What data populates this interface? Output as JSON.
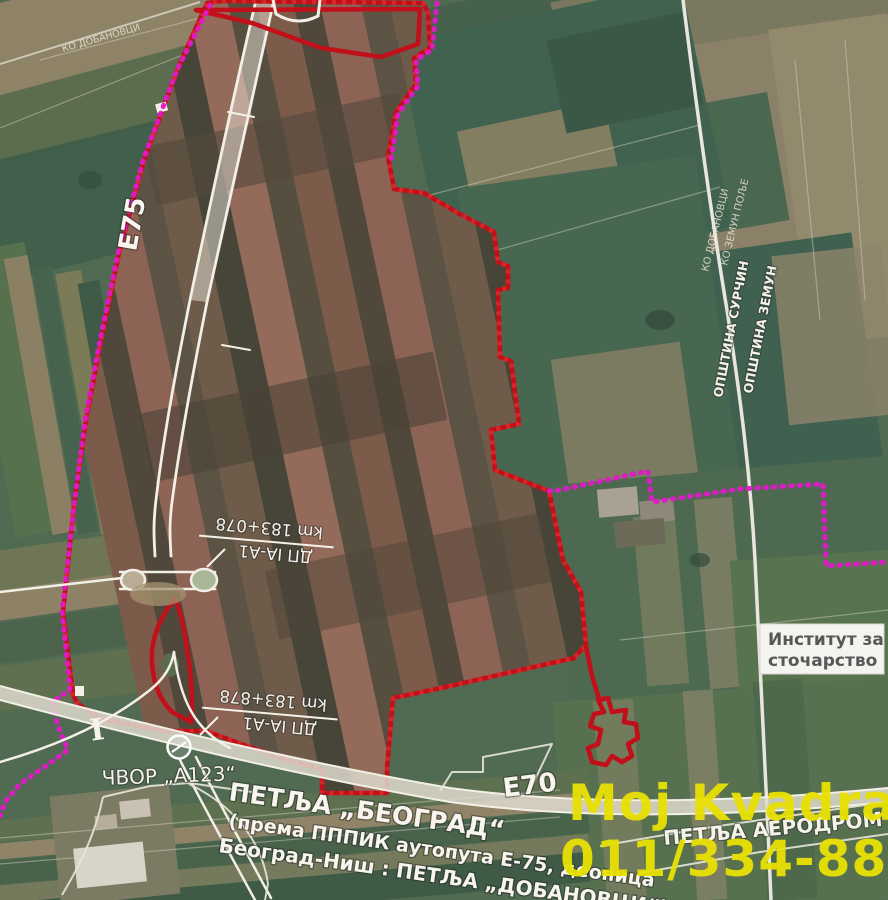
{
  "map": {
    "highway_labels": {
      "e75": "E75",
      "e70": "E70"
    },
    "junction": {
      "cvor": "ЧВОР „А123“",
      "petlja_title": "ПЕТЉА „БЕОГРАД“",
      "petlja_sub1": "(према ПППИК аутопута Е-75, деоница",
      "petlja_sub2": "Београд-Ниш : ПЕТЉА „ДОБАНОВЦИ“)",
      "petlja_aerodrom": "ПЕТЉА АЕРОДРОМ"
    },
    "road_markers": [
      {
        "road": "ДП IА-А1",
        "km": "km 183+078"
      },
      {
        "road": "ДП IА-А1",
        "km": "km 183+878"
      }
    ],
    "admin_labels": {
      "municipality_left": "ОПШТИНА СУРЧИН",
      "municipality_right": "ОПШТИНА ЗЕМУН",
      "cadastre_right_west": "КО ДОБАНОВЦИ",
      "cadastre_right_east": "КО ЗЕМУН ПОЉЕ",
      "cadastre_topleft": "КО ДОБАНОВЦИ"
    },
    "poi": {
      "institute_line1": "Институт за",
      "institute_line2": "сточарство"
    },
    "watermark": {
      "line1": "Moj Kvadrat",
      "line2": "011/334-88-36",
      "color": "#e9e103"
    },
    "colors": {
      "plan_boundary_red": "#c2101a",
      "cadastre_boundary_magenta": "#e318c8",
      "hatch_red": "#c3302c",
      "road_white": "#f2efe7",
      "field_green": "#516a52"
    }
  }
}
